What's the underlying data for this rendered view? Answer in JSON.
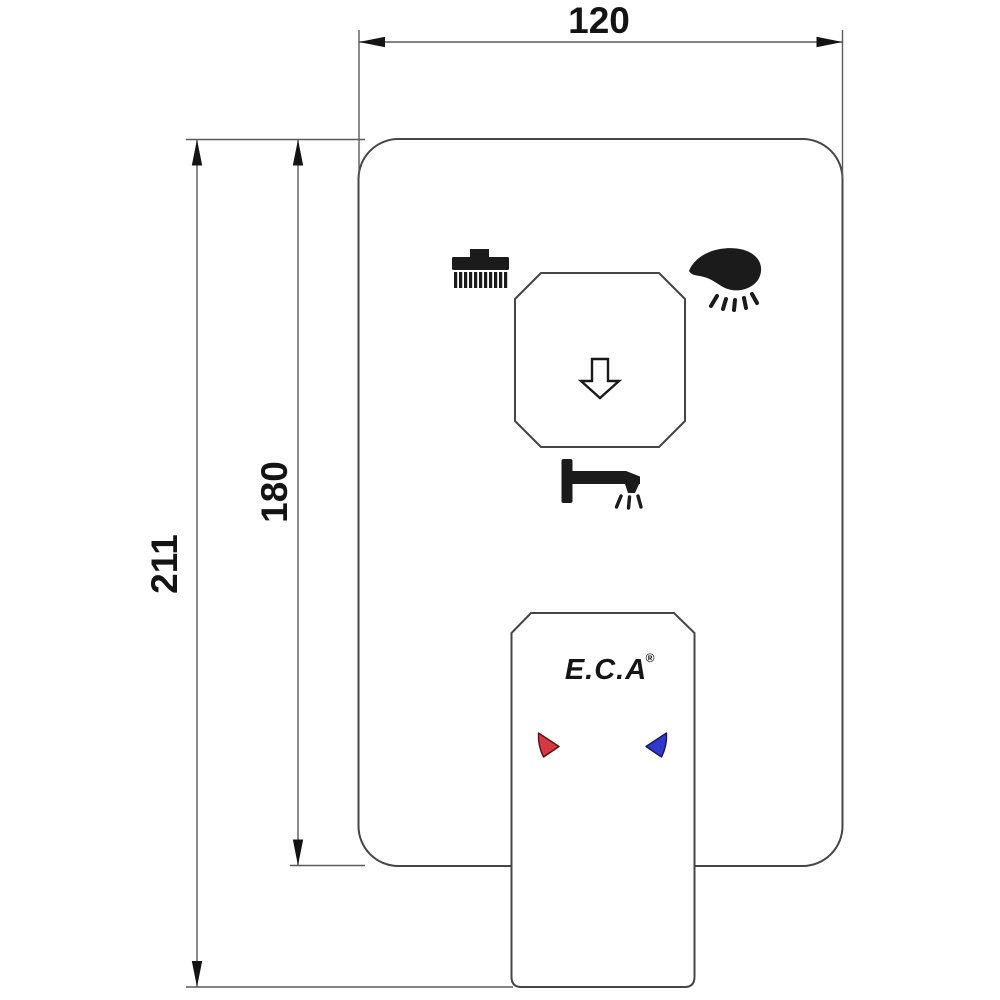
{
  "drawing": {
    "dimensions": {
      "width": "120",
      "inner_height": "180",
      "outer_height": "211"
    },
    "brand": {
      "name": "E.C.A",
      "registered": "®"
    },
    "colors": {
      "hot": "#d63a40",
      "cold": "#3139cb"
    },
    "icons": [
      {
        "name": "rain-shower-icon"
      },
      {
        "name": "hand-shower-icon"
      },
      {
        "name": "diverter-arrow-icon"
      },
      {
        "name": "bath-spout-icon"
      },
      {
        "name": "hot-indicator-icon"
      },
      {
        "name": "cold-indicator-icon"
      }
    ]
  }
}
